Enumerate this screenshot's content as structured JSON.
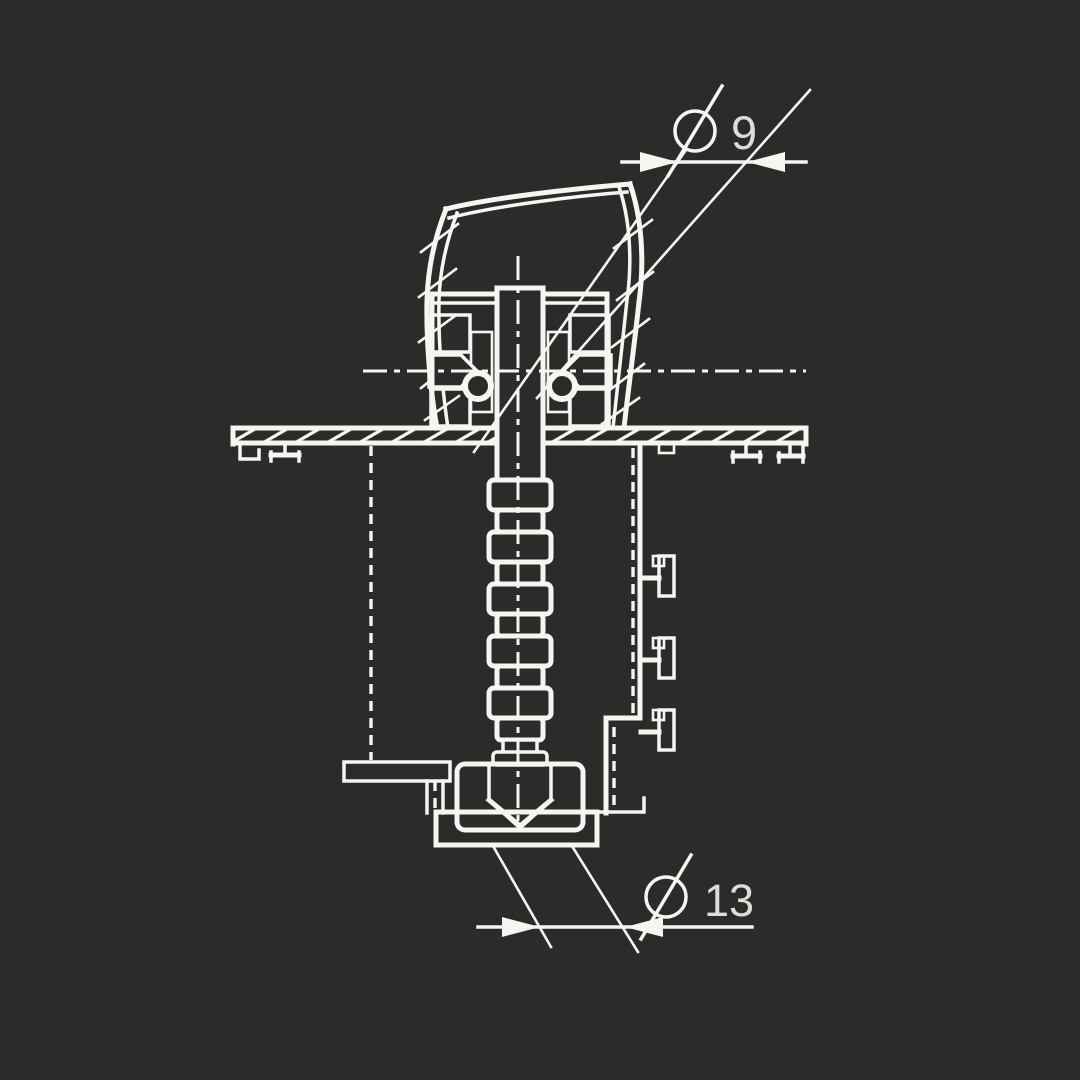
{
  "colors": {
    "background": "#2d2b29",
    "line": "#f7f5f2",
    "text": "#dedcd9"
  },
  "dimensions": {
    "top": {
      "symbol": "Ø",
      "value": "9",
      "label": "Ø 9"
    },
    "bottom": {
      "symbol": "Ø",
      "value": "13",
      "label": "Ø 13"
    }
  }
}
